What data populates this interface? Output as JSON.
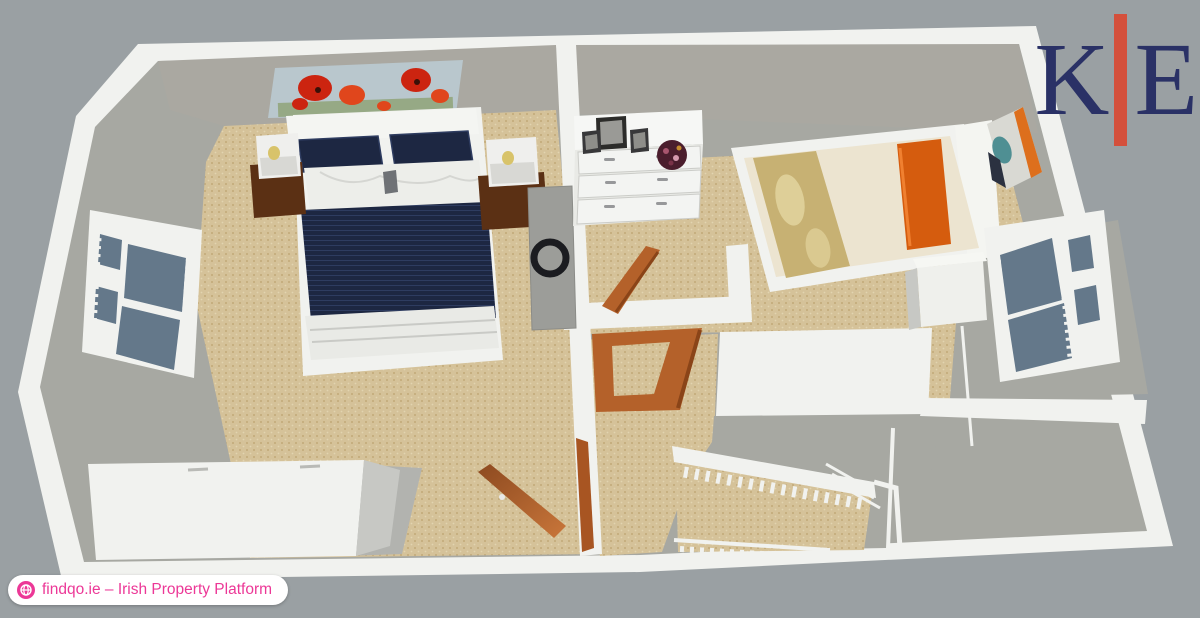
{
  "branding": {
    "logo": {
      "letter_left": "K",
      "letter_right": "E"
    },
    "badge": {
      "label": "findqo.ie – Irish Property Platform"
    }
  },
  "colors": {
    "bg": "#9aa0a3",
    "wall": "#f1f2ef",
    "wall-shade": "#c7c8c4",
    "wall-face": "#aaa8a1",
    "floor-gray": "#a7a8a2",
    "floor-gray2": "#b2b3af",
    "carpet": "#d5c299",
    "carpet-dot": "#c2a978",
    "carpet-dot2": "#e2d4b0",
    "navy": "#1d2742",
    "navy-light": "#2e3c60",
    "glass": "#64788a",
    "wood-dark": "#5b3014",
    "wood-door": "#b4612a",
    "wood-door-dark": "#8a4418",
    "orange": "#d55c0e",
    "orange-light": "#f08030",
    "gold": "#c7b173",
    "gold-light": "#e6d9a4",
    "cream": "#ece4d0",
    "rug": "#9c9d99",
    "ring": "#1b1c20",
    "sky": "#b9c7cd",
    "poppy-red": "#cc2410",
    "poppy-red2": "#e0461c",
    "bowl": "#4b1e2d",
    "logo-navy": "#2a3166",
    "logo-red": "#d4503c",
    "brand-pink": "#ec3897"
  },
  "scene": {
    "type": "3d-floor-plan",
    "view": "aerial cutaway of upper floor",
    "rooms": [
      {
        "name": "master-bedroom",
        "contents": [
          "double-bed-navy-bedding",
          "poppy-wall-art",
          "nightstand-left-with-lamp",
          "nightstand-right-with-lamp",
          "window-left-wall",
          "gray-runner-rug-with-ring",
          "fitted-wardrobe",
          "open-wood-door"
        ]
      },
      {
        "name": "second-bedroom",
        "contents": [
          "single-bed-cream-bedding",
          "orange-pillow",
          "gold-throw",
          "white-dresser-six-drawers",
          "photo-frames",
          "flower-bowl",
          "abstract-wall-art",
          "window-right-wall",
          "bedside-unit",
          "open-wood-door"
        ]
      },
      {
        "name": "landing",
        "contents": [
          "staircase",
          "stair-railing-with-balusters",
          "open-door-frame"
        ]
      }
    ]
  }
}
